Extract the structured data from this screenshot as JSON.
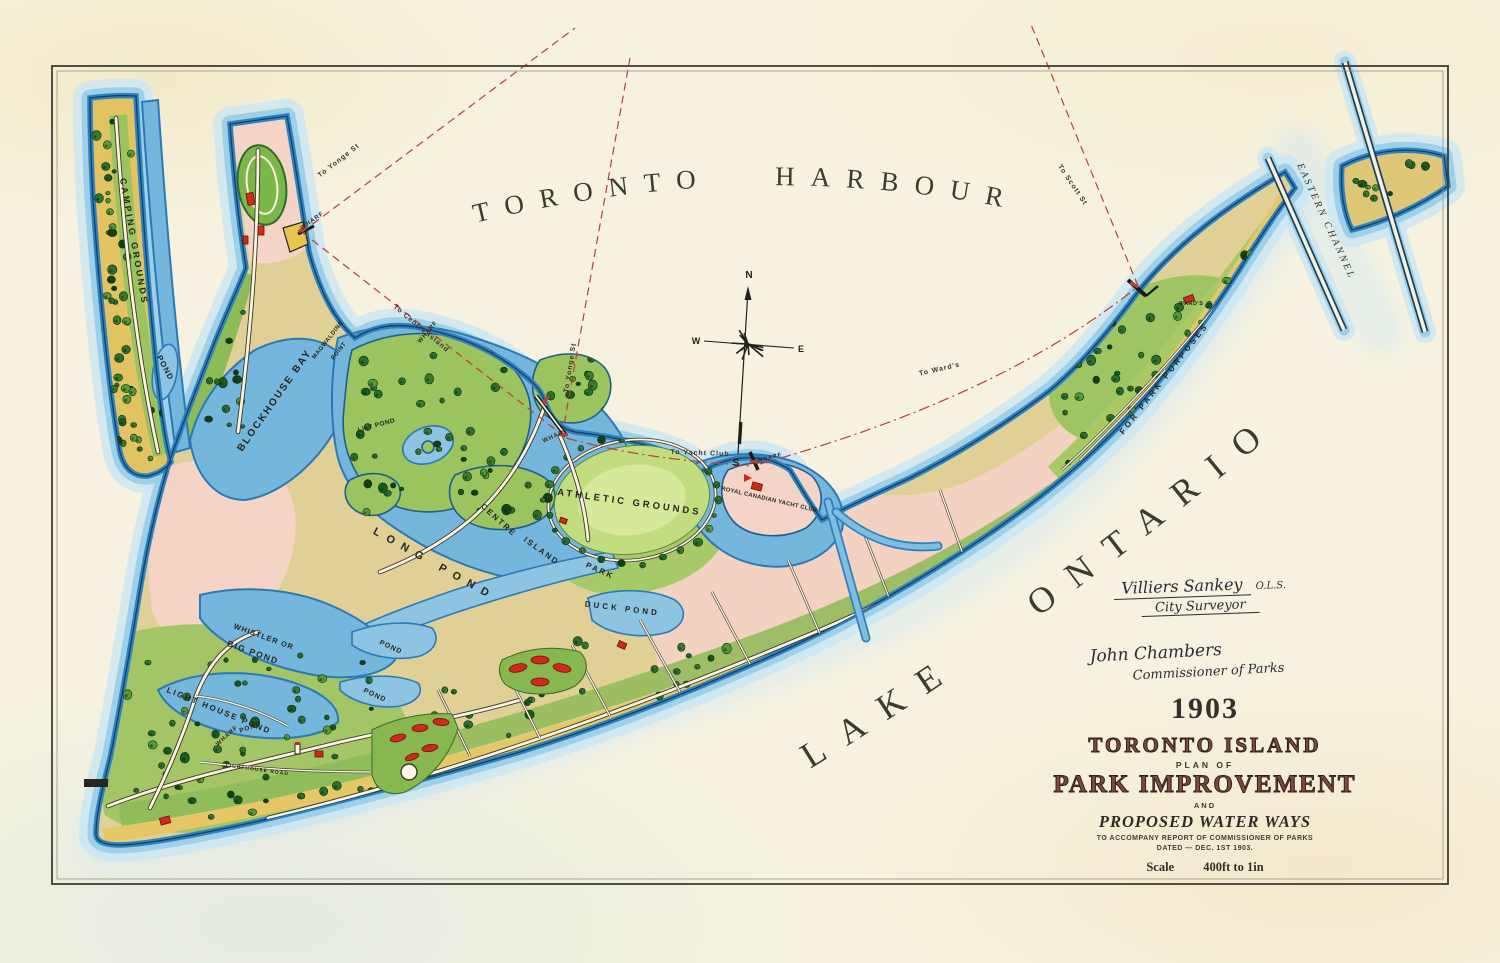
{
  "title_block": {
    "year": "1903",
    "island_title": "TORONTO ISLAND",
    "plan_of": "PLAN OF",
    "main_title": "PARK IMPROVEMENT",
    "subtitle_and": "AND",
    "water_ways": "PROPOSED WATER WAYS",
    "accompany": "TO ACCOMPANY REPORT OF COMMISSIONER OF PARKS",
    "dated": "DATED — DEC. 1ST 1903.",
    "scale_label": "Scale",
    "scale_value": "400ft to 1in"
  },
  "signatures": {
    "surveyor_name": "Villiers Sankey",
    "surveyor_degree": "O.L.S.",
    "surveyor_title": "City Surveyor",
    "commissioner_name": "John Chambers",
    "commissioner_title": "Commissioner of Parks"
  },
  "water_labels": {
    "harbour": "TORONTO HARBOUR",
    "lake": "LAKE ONTARIO",
    "eastern_channel": "EASTERN CHANNEL"
  },
  "compass": {
    "n": "N",
    "e": "E",
    "s": "S",
    "w": "W"
  },
  "map_labels": [
    {
      "t": "CAMPING GROUNDS",
      "x": 131,
      "y": 242,
      "r": 80,
      "s": 9,
      "ls": 2.5,
      "k": "place"
    },
    {
      "t": "POND",
      "x": 163,
      "y": 369,
      "r": 62,
      "s": 8,
      "ls": 1,
      "k": "place"
    },
    {
      "t": "BLOCKHOUSE BAY",
      "x": 277,
      "y": 402,
      "r": -55,
      "s": 10,
      "ls": 2,
      "k": "place"
    },
    {
      "t": "MAGWALDINE",
      "x": 329,
      "y": 341,
      "r": -52,
      "s": 6,
      "ls": 0.5,
      "k": "place"
    },
    {
      "t": "POINT",
      "x": 340,
      "y": 352,
      "r": -52,
      "s": 6,
      "ls": 0.5,
      "k": "place"
    },
    {
      "t": "LILY POND",
      "x": 377,
      "y": 427,
      "r": -15,
      "s": 6.5,
      "ls": 0.5,
      "k": "place"
    },
    {
      "t": "LONG POND",
      "x": 433,
      "y": 567,
      "r": 29,
      "s": 11,
      "ls": 8,
      "k": "place"
    },
    {
      "t": "CENTRE",
      "x": 497,
      "y": 522,
      "r": 42,
      "s": 8,
      "ls": 2,
      "k": "place"
    },
    {
      "t": "ISLAND",
      "x": 540,
      "y": 553,
      "r": 36,
      "s": 8,
      "ls": 2,
      "k": "place"
    },
    {
      "t": "PARK",
      "x": 599,
      "y": 573,
      "r": 24,
      "s": 8,
      "ls": 2,
      "k": "place"
    },
    {
      "t": "ATHLETIC GROUNDS",
      "x": 629,
      "y": 505,
      "r": 8,
      "s": 9.5,
      "ls": 3,
      "k": "place"
    },
    {
      "t": "DUCK POND",
      "x": 622,
      "y": 611,
      "r": 7,
      "s": 8,
      "ls": 3,
      "k": "place"
    },
    {
      "t": "ROYAL CANADIAN YACHT CLUB",
      "x": 769,
      "y": 501,
      "r": 13,
      "s": 5.8,
      "ls": 0.3,
      "k": "place"
    },
    {
      "t": "WHISTLER OR",
      "x": 263,
      "y": 639,
      "r": 20,
      "s": 7.5,
      "ls": 1,
      "k": "place"
    },
    {
      "t": "BIG POND",
      "x": 252,
      "y": 655,
      "r": 20,
      "s": 8.5,
      "ls": 1.5,
      "k": "place"
    },
    {
      "t": "LIGHT HOUSE POND",
      "x": 218,
      "y": 713,
      "r": 22,
      "s": 8,
      "ls": 2,
      "k": "place"
    },
    {
      "t": "POND",
      "x": 390,
      "y": 649,
      "r": 25,
      "s": 7,
      "ls": 1,
      "k": "place"
    },
    {
      "t": "POND",
      "x": 374,
      "y": 697,
      "r": 25,
      "s": 7,
      "ls": 1,
      "k": "place"
    },
    {
      "t": "POND",
      "x": 251,
      "y": 729,
      "r": -20,
      "s": 6.5,
      "ls": 1,
      "k": "place"
    },
    {
      "t": "WARD'S",
      "x": 1191,
      "y": 305,
      "r": 0,
      "s": 5.5,
      "ls": 0.5,
      "k": "place"
    },
    {
      "t": "FOR PARK PURPOSES",
      "x": 1166,
      "y": 380,
      "r": -52,
      "s": 8,
      "ls": 3,
      "k": "place"
    },
    {
      "t": "LIGHTHOUSE ROAD",
      "x": 257,
      "y": 771,
      "r": 8,
      "s": 5,
      "ls": 1,
      "k": "place"
    },
    {
      "t": "WHARF",
      "x": 313,
      "y": 222,
      "r": -35,
      "s": 6,
      "ls": 1,
      "k": "wharf"
    },
    {
      "t": "WHARF",
      "x": 429,
      "y": 333,
      "r": -50,
      "s": 6,
      "ls": 1,
      "k": "wharf"
    },
    {
      "t": "WHARF",
      "x": 556,
      "y": 437,
      "r": -25,
      "s": 6,
      "ls": 1,
      "k": "wharf"
    },
    {
      "t": "WHARF",
      "x": 770,
      "y": 459,
      "r": -15,
      "s": 5.5,
      "ls": 1,
      "k": "wharf"
    },
    {
      "t": "WHARF",
      "x": 228,
      "y": 737,
      "r": -42,
      "s": 6,
      "ls": 1,
      "k": "wharf"
    },
    {
      "t": "WHARF",
      "x": 98,
      "y": 783,
      "r": 0,
      "s": 5,
      "ls": 1,
      "k": "wharf"
    },
    {
      "t": "To Yonge St",
      "x": 340,
      "y": 162,
      "r": -38,
      "s": 7,
      "ls": 1,
      "k": "route"
    },
    {
      "t": "To Centre Island",
      "x": 420,
      "y": 330,
      "r": 40,
      "s": 7,
      "ls": 1,
      "k": "route"
    },
    {
      "t": "To Yonge St",
      "x": 572,
      "y": 368,
      "r": -81,
      "s": 7,
      "ls": 1,
      "k": "route"
    },
    {
      "t": "To Yacht Club",
      "x": 700,
      "y": 455,
      "r": 2,
      "s": 7,
      "ls": 1,
      "k": "route"
    },
    {
      "t": "To Ward's",
      "x": 940,
      "y": 371,
      "r": -13,
      "s": 7,
      "ls": 1,
      "k": "route"
    },
    {
      "t": "To Scott St",
      "x": 1071,
      "y": 186,
      "r": 56,
      "s": 7,
      "ls": 1,
      "k": "route"
    }
  ],
  "colors": {
    "paper": "#f6f2df",
    "water_deep": "#2e82c2",
    "water_mid": "#74b6dc",
    "water_light": "#cde6f2",
    "land_pink": "#f4d4c6",
    "sand": "#e2c362",
    "grass": "#9cc45e",
    "tree": "#1d5c24",
    "route_red": "#b94034",
    "building_red": "#cf2a1b",
    "ink": "#26261f",
    "title_brown": "#7d4a40"
  }
}
